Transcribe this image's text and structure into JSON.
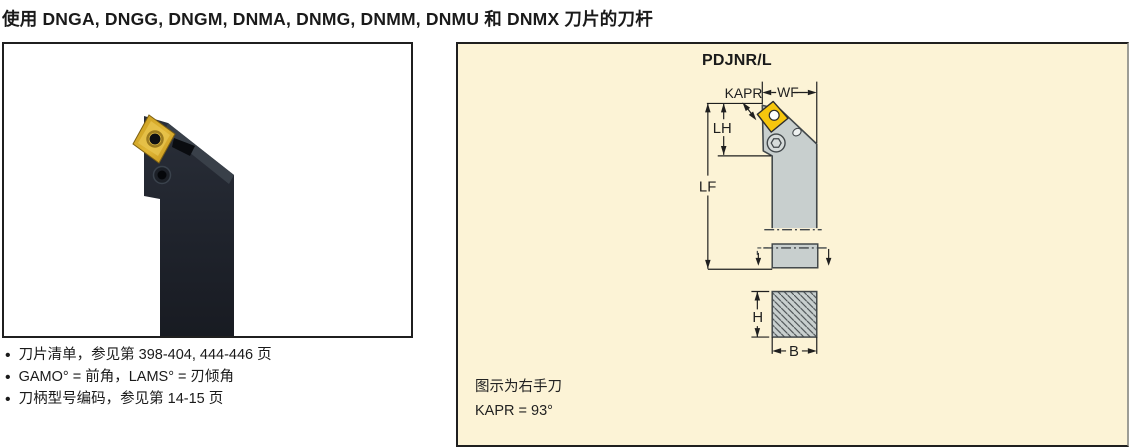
{
  "theme": {
    "page_bg": "#ffffff",
    "text": "#1a1a1a",
    "panel_bg": "#fcf3d6",
    "panel_border": "#1f1f1f",
    "box_border": "#1f1f1f",
    "steel": "#c8cfce",
    "outline": "#41474a",
    "dim": "#1f1f1f",
    "insert_gold": "#f6c60d",
    "photo_body": "#20242d",
    "photo_face": "#394049",
    "photo_gold": "#d3a32c"
  },
  "header": {
    "title": "使用 DNGA, DNGG, DNGM, DNMA, DNMG, DNMM, DNMU 和 DNMX 刀片的刀杆"
  },
  "notes": {
    "items": [
      "刀片清单，参见第 398-404, 444-446 页",
      "GAMO° = 前角，LAMS° = 刃倾角",
      "刀柄型号编码，参见第 14-15 页"
    ]
  },
  "diagram": {
    "title": "PDJNR/L",
    "labels": {
      "kapr": "KAPR",
      "wf": "WF",
      "lh": "LH",
      "lf": "LF",
      "h": "H",
      "b": "B"
    },
    "caption": [
      "图示为右手刀",
      "KAPR = 93°"
    ]
  }
}
